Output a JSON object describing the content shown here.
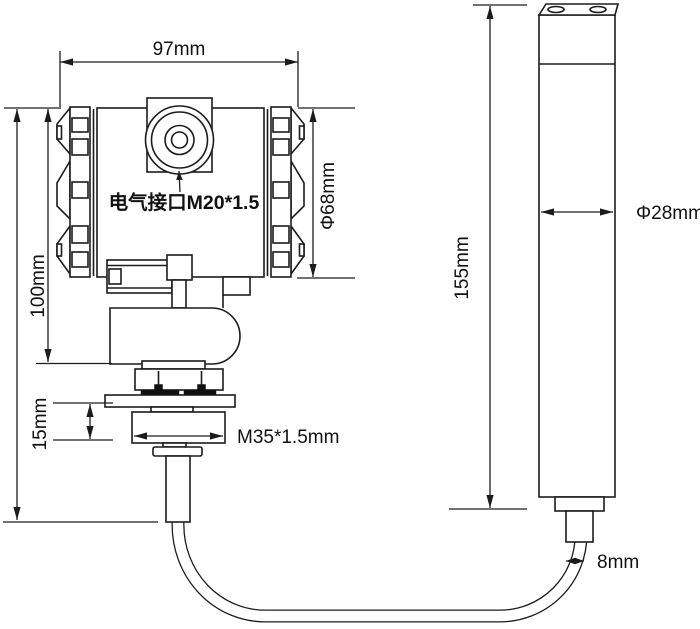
{
  "colors": {
    "background": "#ffffff",
    "line": "#1c1c1c",
    "text": "#111111",
    "gasket_fill": "#111111"
  },
  "transmitter_view": {
    "width_dimension": "97mm",
    "height_dimension": "100mm",
    "cover_diameter_dimension": "Φ68mm",
    "electrical_port_label": "电气接口M20*1.5",
    "thread_height_dimension": "15mm",
    "process_thread_label": "M35*1.5mm"
  },
  "probe_view": {
    "length_dimension": "155mm",
    "diameter_dimension": "Φ28mm",
    "cable_diameter_dimension": "8mm"
  }
}
